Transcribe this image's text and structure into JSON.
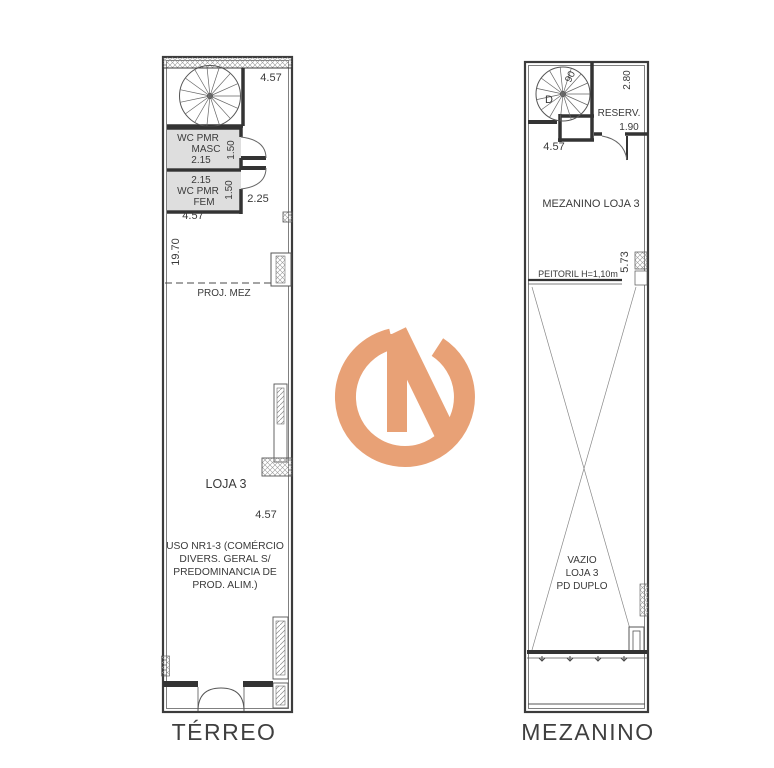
{
  "page": {
    "background": "#ffffff"
  },
  "watermark": {
    "logo_color": "#e8a176"
  },
  "terreo": {
    "title": "TÉRREO",
    "dim_top_width": "4.57",
    "wc_masc_line1": "WC PMR",
    "wc_masc_line2": "MASC",
    "wc_masc_width": "2.15",
    "wc_masc_depth": "1.50",
    "wc_fem_width": "2.15",
    "wc_fem_line1": "WC PMR",
    "wc_fem_line2": "FEM",
    "wc_fem_depth": "1.50",
    "dim_hall": "2.25",
    "dim_inner_width": "4.57",
    "dim_length": "19.70",
    "proj_mez": "PROJ. MEZ",
    "loja": "LOJA 3",
    "dim_mid_width": "4.57",
    "uso_line1": "USO NR1-3 (COMÉRCIO",
    "uso_line2": "DIVERS. GERAL S/",
    "uso_line3": "PREDOMINANCIA DE",
    "uso_line4": "PROD. ALIM.)"
  },
  "mezanino": {
    "title": "MEZANINO",
    "stair_dim": "90",
    "stair_dir": "D",
    "reserv": "RESERV.",
    "reserv_height": "2.80",
    "reserv_width": "1.90",
    "dim_width": "4.57",
    "room": "MEZANINO LOJA 3",
    "peitoril": "PEITORIL H=1,10m",
    "dim_void_height": "5.73",
    "vazio_line1": "VAZIO",
    "vazio_line2": "LOJA 3",
    "vazio_line3": "PD DUPLO"
  }
}
